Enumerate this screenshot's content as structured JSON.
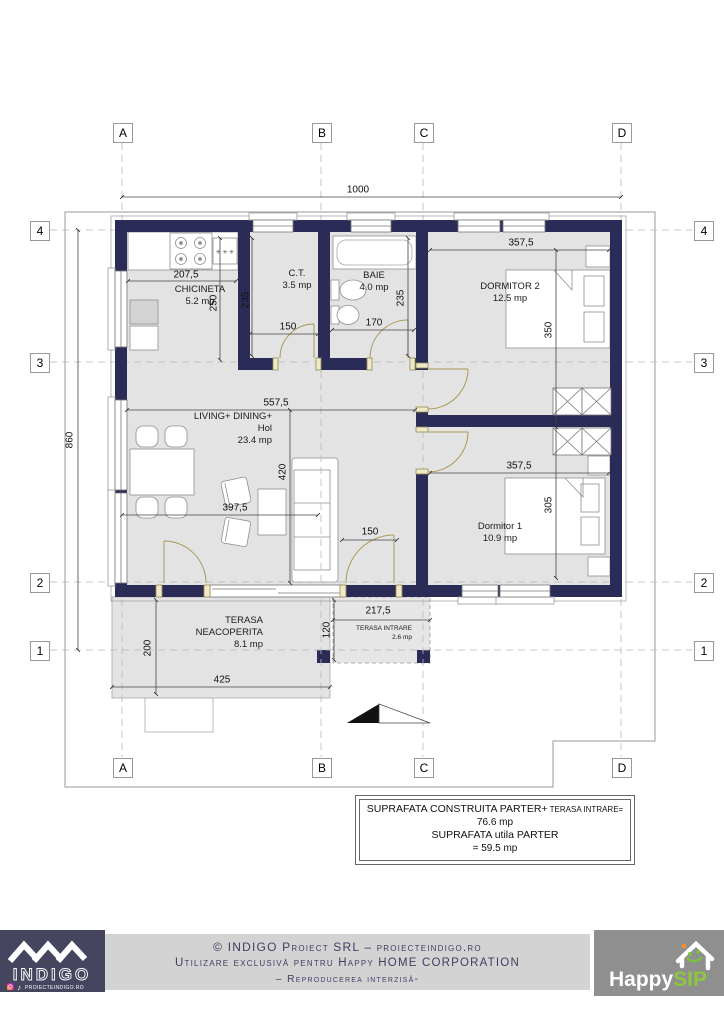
{
  "grid": {
    "cols": [
      "A",
      "B",
      "C",
      "D"
    ],
    "rows": [
      "4",
      "3",
      "2",
      "1"
    ]
  },
  "dims": {
    "overall_w": "1000",
    "overall_h": "860",
    "kitchen_w": "207,5",
    "kitchen_d": "250",
    "ct_w": "150",
    "ct_h": "235",
    "baie_w": "170",
    "baie_h": "235",
    "dorm2_w": "357,5",
    "dorm2_h": "350",
    "living_w": "557,5",
    "living_h": "420",
    "living_w2": "397,5",
    "entry_w": "150",
    "dorm1_w": "357,5",
    "dorm1_h": "305",
    "terasa_w": "425",
    "terasa_d": "200",
    "ti_w": "217,5",
    "ti_d": "120"
  },
  "rooms": {
    "chicineta": {
      "name": "CHICINETA",
      "area": "5.2 mp"
    },
    "ct": {
      "name": "C.T.",
      "area": "3.5 mp"
    },
    "baie": {
      "name": "BAIE",
      "area": "4.0 mp"
    },
    "dormitor2": {
      "name": "DORMITOR 2",
      "area": "12.5 mp"
    },
    "living": {
      "line1": "LIVING+ DINING+",
      "line2": "Hol",
      "area": "23.4 mp"
    },
    "dormitor1": {
      "name": "Dormitor 1",
      "area": "10.9 mp"
    },
    "terasa": {
      "line1": "TERASA",
      "line2": "NEACOPERITA",
      "area": "8.1 mp"
    },
    "terasa_intrare": {
      "name": "TERASA INTRARE",
      "area": "2.6 mp"
    }
  },
  "symbols": {
    "stove_burners": "✳ ✳ ✳"
  },
  "summary": {
    "row1_label": "SUPRAFATA CONSTRUITA PARTER+",
    "row1_label_small": " TERASA INTRARE=",
    "row1_value": "76.6 mp",
    "row2_label": "SUPRAFATA utila PARTER",
    "row2_value": "= 59.5 mp"
  },
  "footer": {
    "line1": "© INDIGO Proiect SRL – proiecteindigo.ro",
    "line2": "Utilizare exclusivă pentru Happy HOME CORPORATION",
    "line3": "– Reproducerea interzisă-",
    "indigo": {
      "wordmark": "INDIGO",
      "website": "PROIECTEINDIGO.RO"
    },
    "happysip": {
      "word1": "Happy",
      "word2": "SIP"
    }
  },
  "colors": {
    "wall": "#2b2b57",
    "room_fill": "#e3e3e3",
    "door": "#a89a55",
    "happysip_green": "#8dc63f",
    "footer_text": "#3e3e63",
    "logo_bg": "#45455f"
  }
}
